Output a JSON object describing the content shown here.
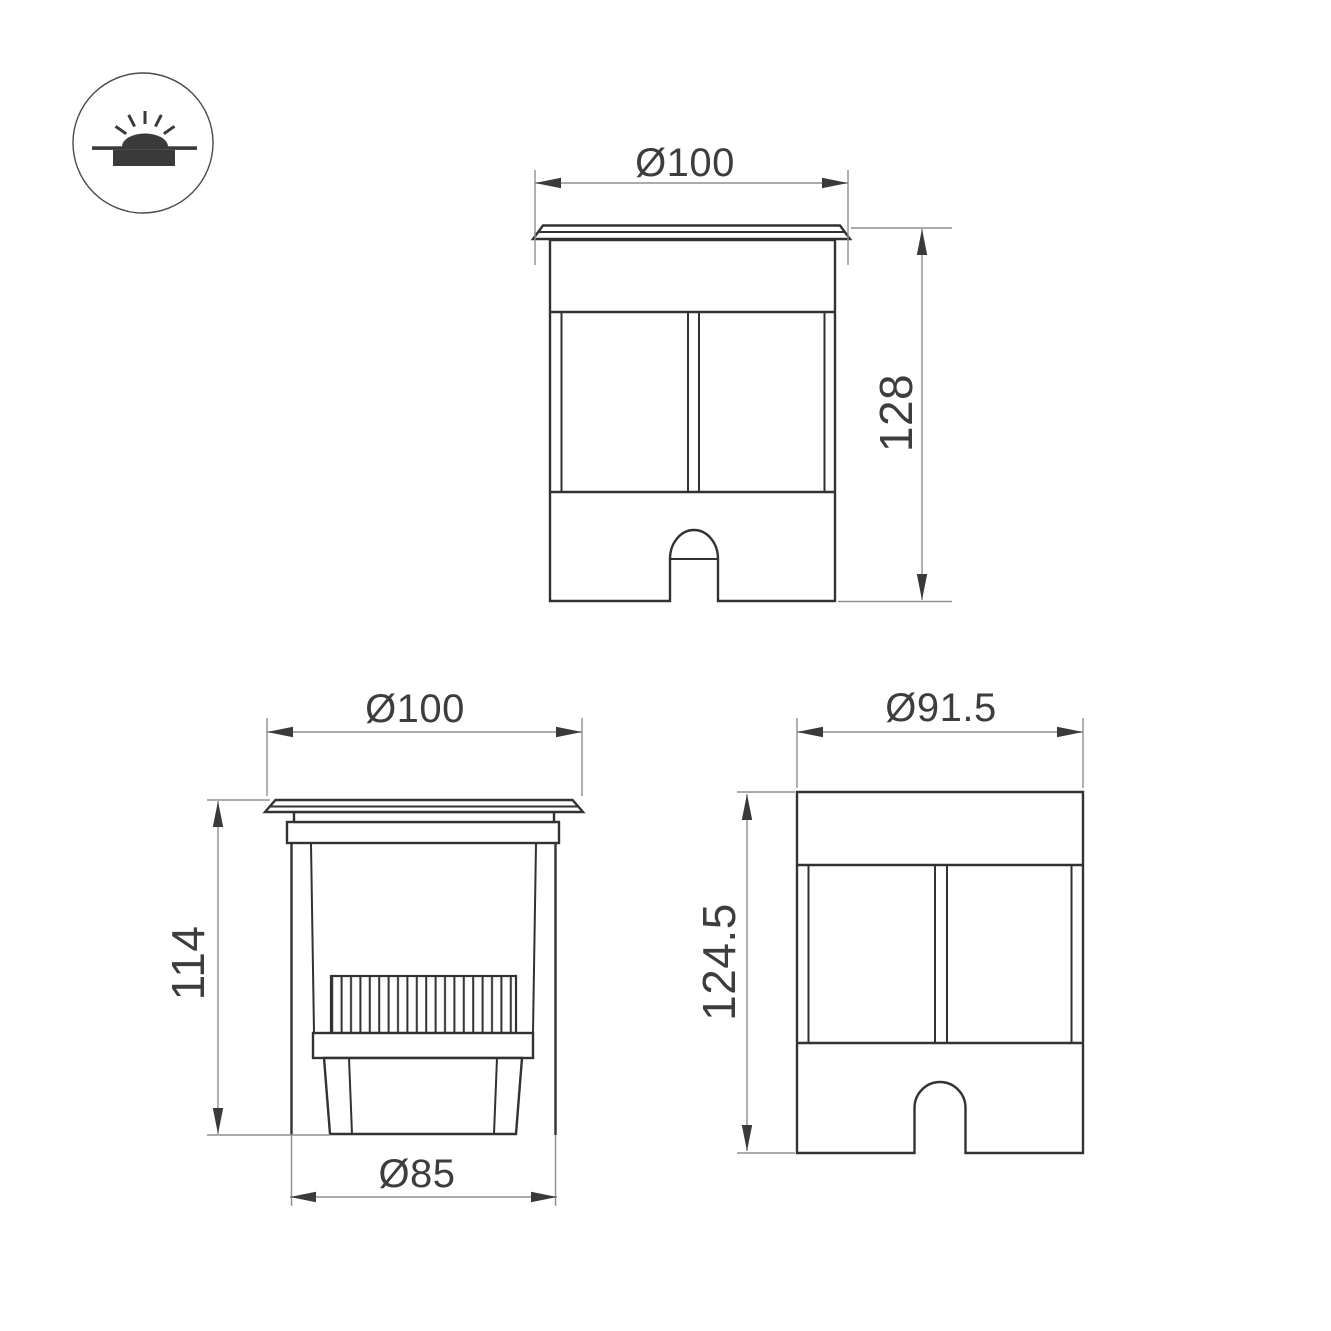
{
  "icon": {
    "type": "recessed-ground-light-symbol"
  },
  "colors": {
    "outline": "#323232",
    "dimension_line": "#8f8f8f",
    "arrow": "#3a3a3a",
    "label_text": "#3d3d3d",
    "background": "#ffffff"
  },
  "views": {
    "front": {
      "diameter": "Ø100",
      "height": "128"
    },
    "section": {
      "top_diameter": "Ø100",
      "height": "114",
      "bottom_diameter": "Ø85"
    },
    "side": {
      "diameter": "Ø91.5",
      "height": "124.5"
    }
  }
}
